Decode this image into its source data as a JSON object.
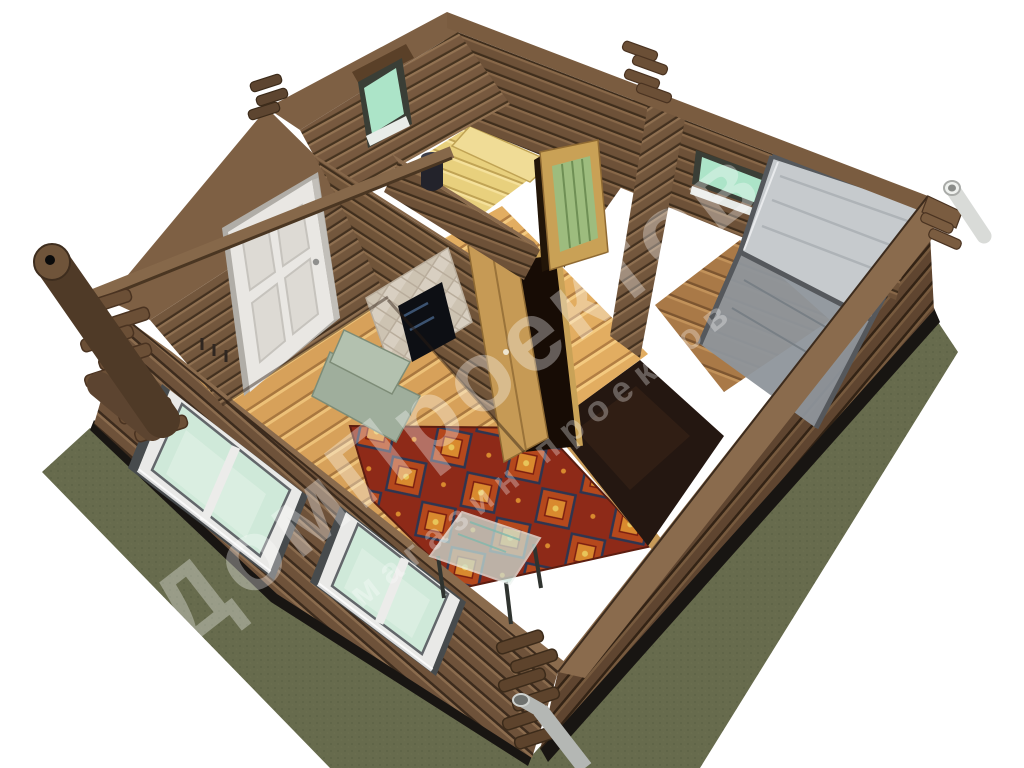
{
  "image": {
    "type": "3d-architectural-render",
    "subject": "roofless cutaway bird's-eye view of a single-storey log house (banya) showing interior rooms",
    "background": "#ffffff"
  },
  "watermark": {
    "line1": "ДомПроектов",
    "line2": "магазин проектов",
    "color": "#ffffff",
    "angle_deg": -38
  },
  "palette": {
    "log_wall": "#6e523a",
    "log_wall_dark": "#5f4530",
    "wall_cap": "#8a6b4d",
    "floor_planks": "#d7a15a",
    "sauna_floor": "#e8d07d",
    "carpet_red": "#8e2a18",
    "grass": "#676b4d",
    "glass_green": "#cfe9d9",
    "small_window_green": "#ace4c8",
    "shower_glass": "#c6cacd",
    "dark_floor": "#241711",
    "foundation": "#181512",
    "white_door": "#e9e7e3",
    "oak_door": "#c69a55",
    "glass_table": "#cfe6dd"
  },
  "rooms": [
    {
      "name": "living room",
      "features": [
        "white entrance door",
        "coat hooks",
        "two front windows",
        "brick fireplace",
        "red oriental carpet",
        "glass coffee table",
        "plank floor"
      ]
    },
    {
      "name": "sauna",
      "features": [
        "yellow plank floor",
        "bench",
        "black stove pipe",
        "small green window"
      ]
    },
    {
      "name": "hallway",
      "features": [
        "open oak door",
        "glazed wooden door",
        "dark glossy floor section"
      ]
    },
    {
      "name": "shower room",
      "features": [
        "corner glass shower cabin",
        "small green window",
        "wooden floor"
      ]
    }
  ],
  "exterior": [
    "stacked log walls",
    "corner log joints",
    "leaning wooden chimney pole",
    "white rain pipe",
    "grey downspout",
    "dark foundation strip",
    "green grass apron"
  ]
}
